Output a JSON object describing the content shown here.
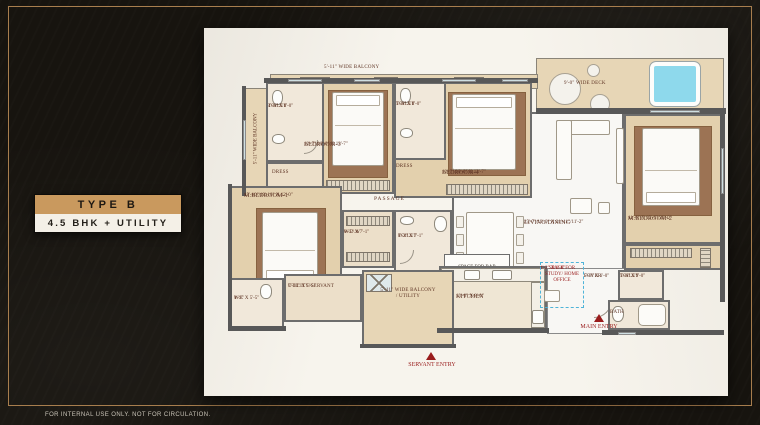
{
  "badge": {
    "title": "TYPE B",
    "subtitle": "4.5 BHK + UTILITY"
  },
  "footer": {
    "disclaimer": "FOR INTERNAL USE ONLY. NOT FOR CIRCULATION."
  },
  "plan": {
    "balconies": {
      "top": "5'-11\" WIDE BALCONY",
      "left": "5'-11\" WIDE BALCONY",
      "deck": "9'-0\" WIDE DECK"
    },
    "rooms": {
      "toilet_bed3": {
        "name": "TOILET",
        "dim": "4'-6\" X 8'-0\""
      },
      "dress_bed3": {
        "name": "DRESS"
      },
      "bedroom3": {
        "name": "BEDROOM-3",
        "dim": "12'-7\"/10'-0\" X 13'-7\""
      },
      "toilet_bed4": {
        "name": "TOILET",
        "dim": "5'-6\" X 8'-0\""
      },
      "dress_bed4": {
        "name": "DRESS"
      },
      "bedroom4": {
        "name": "BEDROOM-4",
        "dim": "12'-7\"/10'-0\" X 13'-7\""
      },
      "master_bedroom2": {
        "name": "M.BEDROOM-2",
        "dim": "11'-6\" X 15'-6\"/22'-0\""
      },
      "master_bedroom1": {
        "name": "M.BEDROOM-1",
        "dim": "15'-10\"/19'-10\" X 12'-0\""
      },
      "passage": {
        "name": "PASSAGE"
      },
      "wdw": {
        "name": "W.D.W",
        "dim": "6'-5\" X 7'-1\""
      },
      "toilet_master1": {
        "name": "TOILET",
        "dim": "8'-2\" X 7'-1\""
      },
      "living_dining": {
        "name": "LIVING/DINING",
        "dim": "25'-7\"/13'-0\" X 21'-11\"/11'-2\""
      },
      "bar": {
        "name": "SPACE FOR BAR"
      },
      "kitchen": {
        "name": "KITCHEN",
        "dim": "13'-0\" X 8'-0\""
      },
      "wc": {
        "name": "W.C",
        "dim": "4'-9\" X 5'-5\""
      },
      "utility_servant": {
        "name": "UTILITY/SERVANT",
        "dim": "7'-10\" X 5'-5\""
      },
      "balcony_utility": {
        "name": "5'-11\" WIDE BALCONY / UTILITY"
      },
      "study": {
        "name": "SPACE FOR STUDY/ HOME OFFICE",
        "dim": "4'-2\" X 6'-0\""
      },
      "foyer": {
        "name": "FOYER",
        "dim": "5'-0\" X 6'-0\""
      },
      "toilet_master2": {
        "name": "TOILET",
        "dim": "5'-6\" X 9'-0\""
      },
      "bath": {
        "name": "BATH"
      }
    },
    "entries": {
      "servant": "SERVANT ENTRY",
      "main": "MAIN ENTRY"
    },
    "colors": {
      "accent_tan": "#C9995E",
      "background": "#17140F",
      "entry_red": "#991C1C",
      "pool_blue": "#8ED9EC"
    }
  }
}
